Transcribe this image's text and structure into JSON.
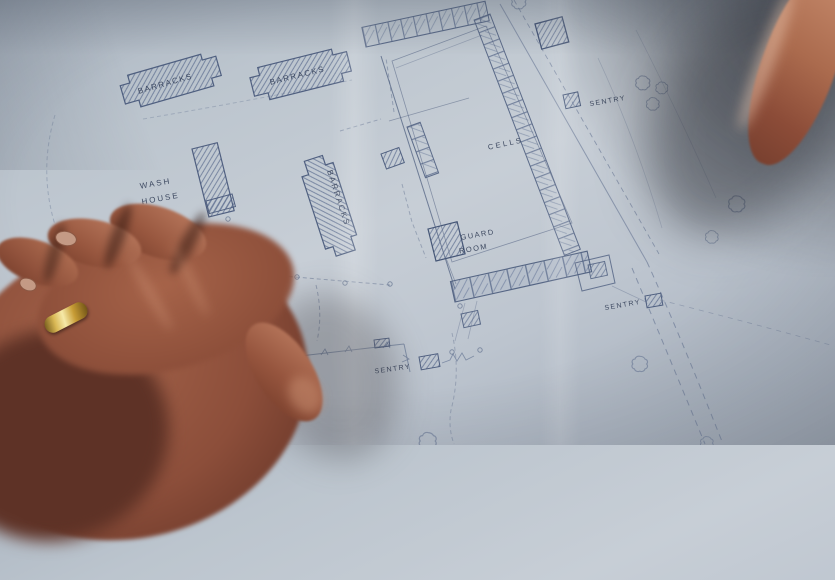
{
  "blueprint": {
    "labels": {
      "barracks_1": "BARRACKS",
      "barracks_2": "BARRACKS",
      "barracks_3": "BARRACKS",
      "wash_house_1": "WASH",
      "wash_house_2": "HOUSE",
      "cells": "CELLS",
      "guard_room_1": "GUARD",
      "guard_room_2": "ROOM",
      "sentry_north": "SENTRY",
      "sentry_south": "SENTRY",
      "sentry_gate": "SENTRY"
    },
    "colors": {
      "paper": "#bcc5ce",
      "ink": "#47587a",
      "ink_faint": "#7b8aa4",
      "label_text": "#333f58"
    }
  },
  "photo": {
    "colors": {
      "skin_mid": "#9a5a42",
      "skin_highlight": "#c4886a",
      "skin_shadow": "#5e3226",
      "ring_gold": "#e8cf7a",
      "cast_shadow": "#2a2d36"
    }
  }
}
